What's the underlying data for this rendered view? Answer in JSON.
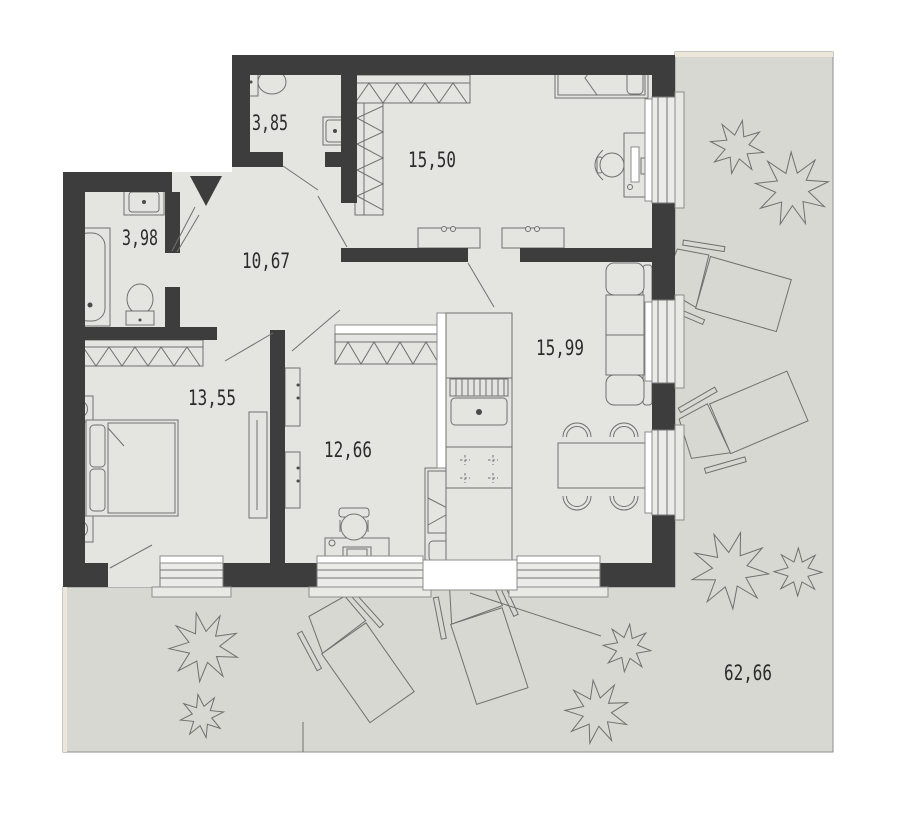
{
  "plan": {
    "rooms": [
      {
        "id": "wc",
        "area": "3,85"
      },
      {
        "id": "bedroom-top",
        "area": "15,50"
      },
      {
        "id": "bathroom",
        "area": "3,98"
      },
      {
        "id": "hallway",
        "area": "10,67"
      },
      {
        "id": "bedroom-left",
        "area": "13,55"
      },
      {
        "id": "room-middle",
        "area": "12,66"
      },
      {
        "id": "living-kitchen",
        "area": "15,99"
      },
      {
        "id": "terrace",
        "area": "62,66"
      }
    ],
    "colors": {
      "wall": "#3d3d3d",
      "floor": "#e4e4e1",
      "terrace": "#d7d8d2",
      "line": "#70706e",
      "trim": "#ece7da",
      "text": "#2b2b2b"
    }
  }
}
